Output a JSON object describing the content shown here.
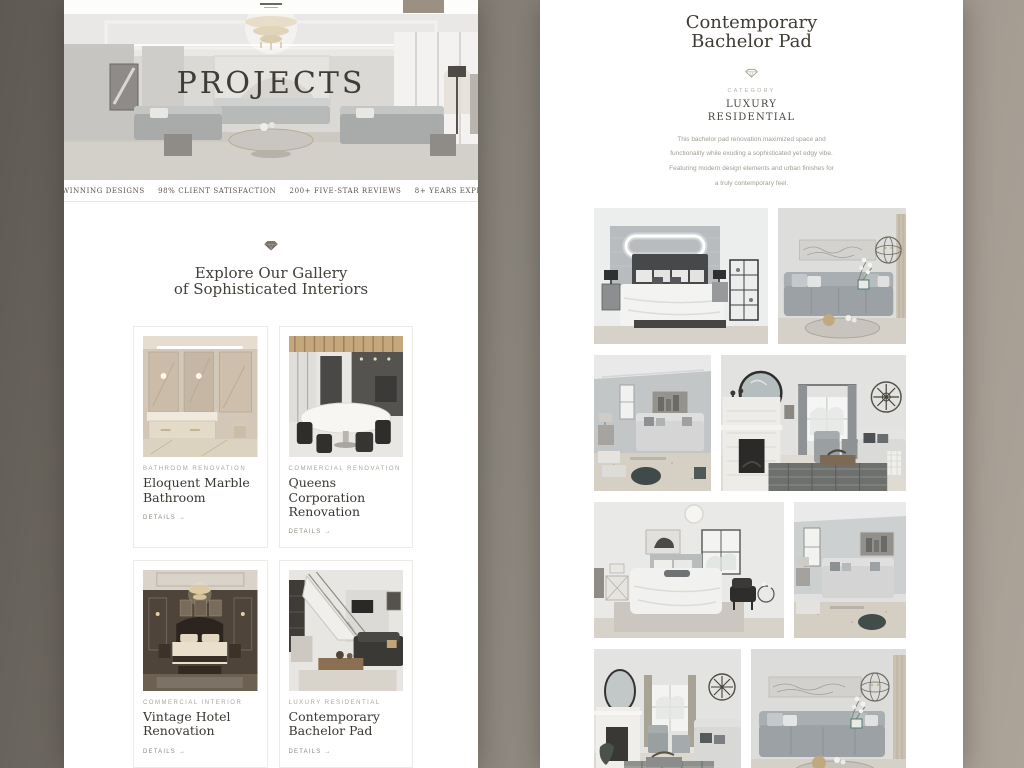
{
  "background": {
    "gradient_left": "#5e5a53",
    "gradient_mid": "#8a857c",
    "gradient_right": "#aca399"
  },
  "projects_page": {
    "hero": {
      "title": "PROJECTS"
    },
    "stats": [
      "WINNING DESIGNS",
      "98% CLIENT SATISFACTION",
      "200+ FIVE-STAR REVIEWS",
      "8+ YEARS EXPER"
    ],
    "intro": {
      "heading_line1": "Explore Our Gallery",
      "heading_line2": "of Sophisticated Interiors"
    },
    "cards": [
      {
        "category": "BATHROOM RENOVATION",
        "title": "Eloquent Marble Bathroom",
        "details": "DETAILS →"
      },
      {
        "category": "COMMERCIAL RENOVATION",
        "title": "Queens Corporation Renovation",
        "details": "DETAILS →"
      },
      {
        "category": "COMMERCIAL INTERIOR",
        "title": "Vintage Hotel Renovation",
        "details": "DETAILS →"
      },
      {
        "category": "LUXURY RESIDENTIAL",
        "title": "Contemporary Bachelor Pad",
        "details": "DETAILS →"
      }
    ]
  },
  "detail_page": {
    "title_line1": "Contemporary",
    "title_line2": "Bachelor Pad",
    "category_label": "CATEGORY",
    "category_value_line1": "LUXURY",
    "category_value_line2": "RESIDENTIAL",
    "description_lines": [
      "This bachelor pad renovation maximized space and",
      "functionality while exuding a sophisticated yet edgy vibe.",
      "Featuring modern design elements and urban finishes for",
      "a truly contemporary feel."
    ]
  },
  "icons": {
    "divider_left": "diamond-icon",
    "divider_right": "diamond-icon"
  },
  "accent_colors": {
    "nav_button": "#9c9082",
    "text_dark": "#3e3a34",
    "label_grey": "#aba59c"
  }
}
